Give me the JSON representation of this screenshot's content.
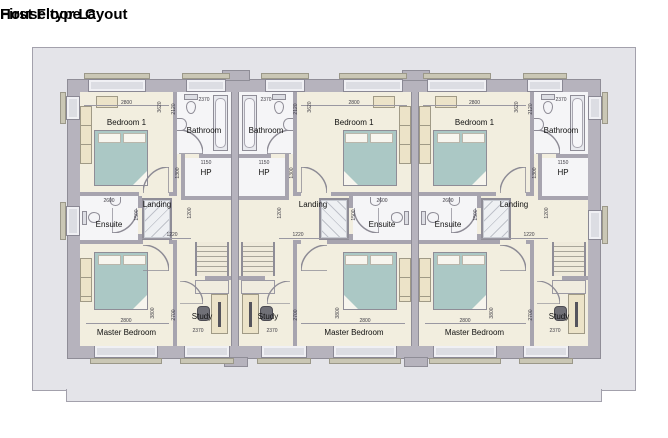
{
  "title": {
    "line1": "House type C",
    "line2": "First Floor Layout"
  },
  "rooms": {
    "bedroom1": "Bedroom 1",
    "bathroom": "Bathroom",
    "hp": "HP",
    "landing": "Landing",
    "ensuite": "Ensuite",
    "study": "Study",
    "master_bedroom": "Master Bedroom"
  },
  "dimensions": {
    "bedroom1_w": "2800",
    "bedroom1_h": "3620",
    "bathroom_w": "2370",
    "bathroom_h": "2120",
    "hp_w": "1150",
    "hp_h": "1300",
    "ensuite_w": "2600",
    "ensuite_h": "1500",
    "landing_w": "1220",
    "stair_w": "1200",
    "master_w": "2800",
    "master_h": "3800",
    "study_w": "2370",
    "study_h": "2700"
  },
  "units": [
    {
      "name": "unit-1",
      "mirrored": false
    },
    {
      "name": "unit-2",
      "mirrored": true
    },
    {
      "name": "unit-3",
      "mirrored": false
    }
  ],
  "colors": {
    "surround": "#e4e4e9",
    "wall": "#b6b3bd",
    "partition": "#a7a4af",
    "floor": "#f2eedf",
    "wet_floor": "#f5f5f7",
    "bed": "#abc8c5",
    "furniture": "#ece3c8",
    "sill": "#cac7b5"
  }
}
